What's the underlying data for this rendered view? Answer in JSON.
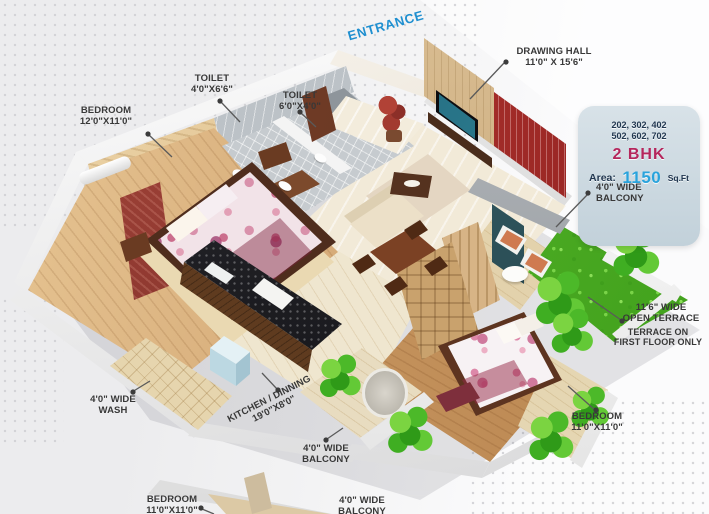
{
  "labels": {
    "entrance": {
      "text": "ENTRANCE",
      "color": "#1e8fd0"
    },
    "drawing_hall": {
      "name": "DRAWING HALL",
      "dims": "11'0\" X 15'6\""
    },
    "toilet1": {
      "name": "TOILET",
      "dims": "4'0\"X6'6\""
    },
    "toilet2": {
      "name": "TOILET",
      "dims": "6'0\"X4'0\""
    },
    "bedroom1": {
      "name": "BEDROOM",
      "dims": "12'0\"X11'0\""
    },
    "balcony_right": {
      "line1": "4'0\" WIDE",
      "line2": "BALCONY"
    },
    "terrace": {
      "line1": "11'6\" WIDE",
      "line2": "OPEN TERRACE"
    },
    "terrace_note": {
      "line1": "TERRACE ON",
      "line2": "FIRST FLOOR ONLY"
    },
    "bedroom2": {
      "name": "BEDROOM",
      "dims": "11'0\"X11'0\""
    },
    "wash": {
      "line1": "4'0\" WIDE",
      "line2": "WASH"
    },
    "kitchen": {
      "name": "KITCHEN / DINNING",
      "dims": "19'0\"X8'0\""
    },
    "balcony_mid": {
      "line1": "4'0\" WIDE",
      "line2": "BALCONY"
    },
    "bedroom3": {
      "name": "BEDROOM",
      "dims": "11'0\"X11'0\""
    },
    "balcony_bottom": {
      "line1": "4'0\" WIDE",
      "line2": "BALCONY"
    }
  },
  "badge": {
    "units_line1": "202, 302, 402",
    "units_line2": "502, 602, 702",
    "bhk": "2 BHK",
    "area_label": "Area:",
    "area_value": "1150",
    "area_unit": "Sq.Ft",
    "colors": {
      "background": "#cdd9e1",
      "navy": "#20364f",
      "magenta": "#b5265c",
      "blue": "#29a3dc"
    }
  }
}
